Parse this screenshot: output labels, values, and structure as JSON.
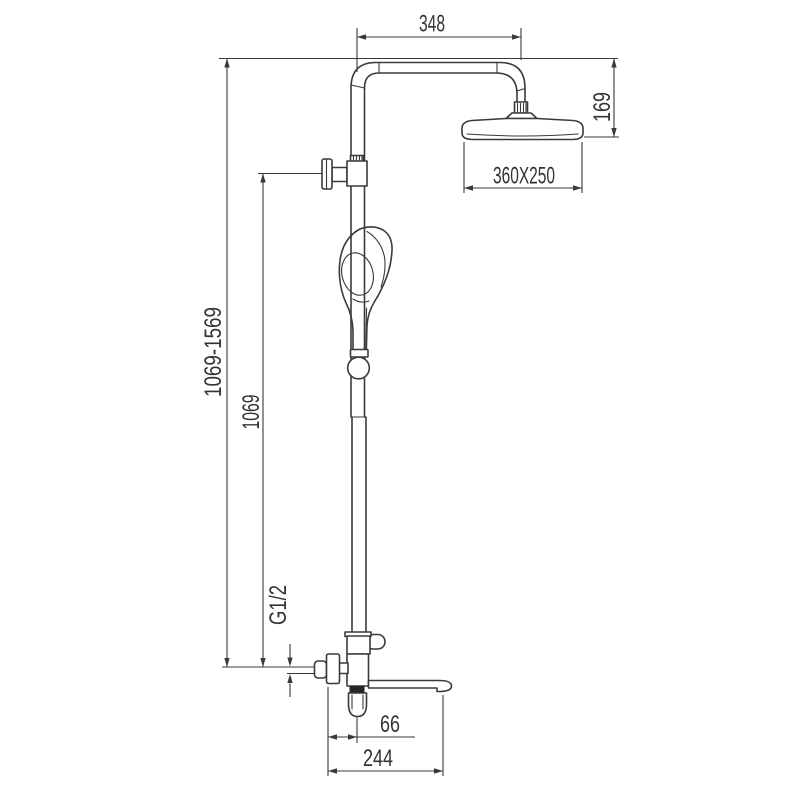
{
  "drawing": {
    "subject": "Shower column technical dimension drawing",
    "background_color": "#ffffff",
    "line_color": "#3a3a3a",
    "text_color": "#333333",
    "accent_dark": "#262626"
  },
  "dimensions": {
    "arm_reach": "348",
    "head_drop_height": "169",
    "head_size": "360X250",
    "overall_height_range": "1069-1569",
    "rail_height": "1069",
    "inlet_thread": "G1/2",
    "spout_offset": "66",
    "spout_reach": "244"
  }
}
